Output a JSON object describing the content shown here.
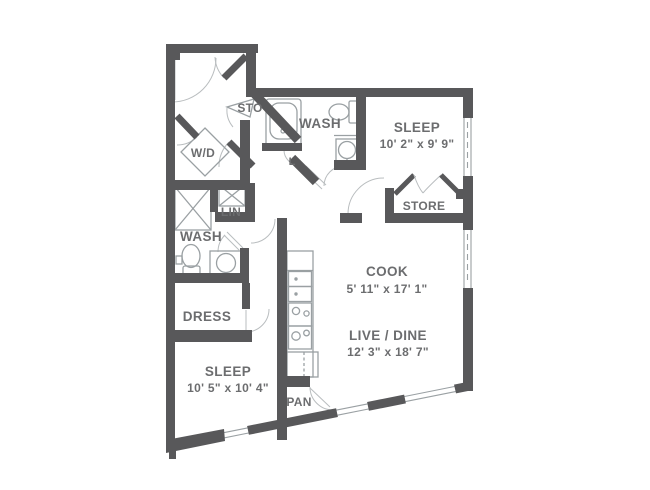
{
  "plan": {
    "title": "apartment-floor-plan",
    "rooms": [
      {
        "id": "sleep-upper",
        "label": "SLEEP",
        "dims": "10' 2\" x 9' 9\""
      },
      {
        "id": "store",
        "label": "STORE",
        "dims": ""
      },
      {
        "id": "wash-upper",
        "label": "WASH",
        "dims": ""
      },
      {
        "id": "sto",
        "label": "STO",
        "dims": ""
      },
      {
        "id": "linen-small",
        "label": "L",
        "dims": ""
      },
      {
        "id": "washer-dryer",
        "label": "W/D",
        "dims": ""
      },
      {
        "id": "linen",
        "label": "LIN",
        "dims": ""
      },
      {
        "id": "wash-lower",
        "label": "WASH",
        "dims": ""
      },
      {
        "id": "dress",
        "label": "DRESS",
        "dims": ""
      },
      {
        "id": "sleep-lower",
        "label": "SLEEP",
        "dims": "10' 5\" x 10' 4\""
      },
      {
        "id": "cook",
        "label": "COOK",
        "dims": "5' 11\" x 17' 1\""
      },
      {
        "id": "live-dine",
        "label": "LIVE / DINE",
        "dims": "12' 3\" x 18' 7\""
      },
      {
        "id": "pantry",
        "label": "PAN",
        "dims": ""
      }
    ],
    "fixtures": [
      "bathtub",
      "toilet",
      "wall-sink",
      "vanity-sink",
      "shower",
      "linen-shelves",
      "washer-dryer-unit",
      "kitchen-sink",
      "range",
      "refrigerator",
      "bifold-doors",
      "door-swings",
      "windows"
    ],
    "colors": {
      "wall": "#58585a",
      "fixture": "#9aa0a3",
      "arc": "#b9bdbf",
      "text": "#6c6d6f",
      "background": "#ffffff"
    }
  }
}
